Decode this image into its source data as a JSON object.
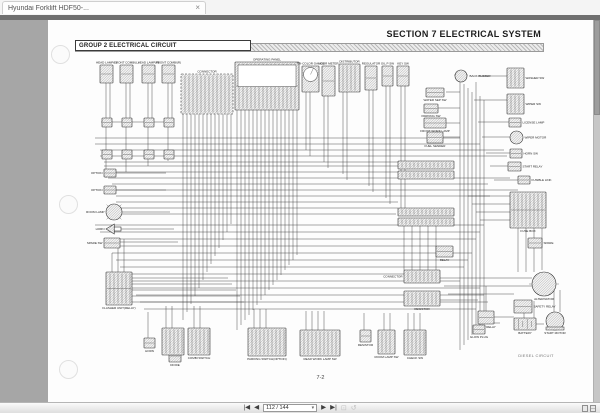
{
  "tab": {
    "title": "Hyundai Forklift HDF50-...",
    "close": "×"
  },
  "colors": {
    "appbar": "#6f6f6f",
    "viewer_bg": "#a6a6a6",
    "page_bg": "#fdfdfd"
  },
  "toolbar": {
    "first_icon": "|◀",
    "prev_icon": "◀",
    "page_value": "112 / 144",
    "dropdown_icon": "▾",
    "next_icon": "▶",
    "last_icon": "▶|",
    "snapshot_icon": "⊡",
    "refresh_icon": "↺"
  },
  "page": {
    "section_header": "SECTION 7  ELECTRICAL  SYSTEM",
    "group_label": "GROUP 2 ELECTRICAL CIRCUIT",
    "caption": "DIESEL CIRCUIT",
    "page_number": "7-2"
  },
  "diagram": {
    "components": [
      {
        "x": 52,
        "y": 45,
        "w": 13,
        "h": 18,
        "s": "conn",
        "l": "HEAD LAMP(L)",
        "p": "top"
      },
      {
        "x": 72,
        "y": 45,
        "w": 13,
        "h": 18,
        "s": "conn",
        "l": "FRONT COMBI(L)",
        "p": "top"
      },
      {
        "x": 94,
        "y": 45,
        "w": 13,
        "h": 18,
        "s": "conn",
        "l": "HEAD LAMP(R)",
        "p": "top"
      },
      {
        "x": 114,
        "y": 45,
        "w": 13,
        "h": 18,
        "s": "conn",
        "l": "FRONT COMBI(R)",
        "p": "top"
      },
      {
        "x": 54,
        "y": 98,
        "w": 10,
        "h": 9,
        "s": "conn"
      },
      {
        "x": 74,
        "y": 98,
        "w": 10,
        "h": 9,
        "s": "conn"
      },
      {
        "x": 96,
        "y": 98,
        "w": 10,
        "h": 9,
        "s": "conn"
      },
      {
        "x": 116,
        "y": 98,
        "w": 10,
        "h": 9,
        "s": "conn"
      },
      {
        "x": 54,
        "y": 130,
        "w": 10,
        "h": 9,
        "s": "conn"
      },
      {
        "x": 74,
        "y": 130,
        "w": 10,
        "h": 9,
        "s": "conn"
      },
      {
        "x": 96,
        "y": 130,
        "w": 10,
        "h": 9,
        "s": "conn"
      },
      {
        "x": 116,
        "y": 130,
        "w": 10,
        "h": 9,
        "s": "conn"
      },
      {
        "x": 133,
        "y": 54,
        "w": 52,
        "h": 40,
        "s": "dashedgrid",
        "l": "CONNECTOR",
        "p": "top"
      },
      {
        "x": 187,
        "y": 42,
        "w": 64,
        "h": 48,
        "s": "panel",
        "l": "OPERATING PANEL",
        "p": "top"
      },
      {
        "x": 254,
        "y": 46,
        "w": 17,
        "h": 26,
        "s": "gauge",
        "l": "TRI-COLOR GAUGE",
        "p": "top"
      },
      {
        "x": 274,
        "y": 46,
        "w": 13,
        "h": 30,
        "s": "conn",
        "l": "HOUR METER",
        "p": "top"
      },
      {
        "x": 291,
        "y": 44,
        "w": 21,
        "h": 28,
        "s": "grid",
        "l": "DISTRIBUTOR",
        "p": "top"
      },
      {
        "x": 317,
        "y": 46,
        "w": 12,
        "h": 24,
        "s": "conn",
        "l": "REGULATOR",
        "p": "top"
      },
      {
        "x": 334,
        "y": 46,
        "w": 11,
        "h": 20,
        "s": "conn",
        "l": "OIL P SW",
        "p": "top"
      },
      {
        "x": 349,
        "y": 46,
        "w": 12,
        "h": 20,
        "s": "conn",
        "l": "KEY SW",
        "p": "top"
      },
      {
        "x": 406,
        "y": 50,
        "w": 14,
        "h": 12,
        "s": "circle",
        "l": "BACK BUZZER",
        "p": "right"
      },
      {
        "x": 378,
        "y": 68,
        "w": 18,
        "h": 9,
        "s": "conn",
        "l": "WATER SEP SW",
        "p": "bottom"
      },
      {
        "x": 376,
        "y": 84,
        "w": 14,
        "h": 9,
        "s": "conn",
        "l": "PARKING SW",
        "p": "bottom"
      },
      {
        "x": 376,
        "y": 98,
        "w": 22,
        "h": 10,
        "s": "conn",
        "l": "FRONT WORK LAMP",
        "p": "bottom"
      },
      {
        "x": 379,
        "y": 112,
        "w": 16,
        "h": 11,
        "s": "conn",
        "l": "FUEL SENDER",
        "p": "bottom"
      },
      {
        "x": 459,
        "y": 48,
        "w": 17,
        "h": 20,
        "s": "grid",
        "l": "WASHER SW",
        "p": "right"
      },
      {
        "x": 459,
        "y": 74,
        "w": 17,
        "h": 20,
        "s": "grid",
        "l": "WIPER SW",
        "p": "right"
      },
      {
        "x": 461,
        "y": 98,
        "w": 12,
        "h": 9,
        "s": "conn",
        "l": "LICENSE LAMP",
        "p": "right"
      },
      {
        "x": 462,
        "y": 111,
        "w": 13,
        "h": 13,
        "s": "circle",
        "l": "WIPER MOTOR",
        "p": "right"
      },
      {
        "x": 462,
        "y": 129,
        "w": 12,
        "h": 9,
        "s": "conn",
        "l": "HORN SW",
        "p": "right"
      },
      {
        "x": 460,
        "y": 142,
        "w": 13,
        "h": 9,
        "s": "conn",
        "l": "START RELAY",
        "p": "right"
      },
      {
        "x": 470,
        "y": 156,
        "w": 12,
        "h": 8,
        "s": "conn",
        "l": "FUSIBLE LINK",
        "p": "right"
      },
      {
        "x": 462,
        "y": 172,
        "w": 36,
        "h": 36,
        "s": "fusebox",
        "l": "FUSE BOX",
        "p": "bottom"
      },
      {
        "x": 480,
        "y": 218,
        "w": 14,
        "h": 10,
        "s": "conn",
        "l": "SPARE",
        "p": "right"
      },
      {
        "x": 388,
        "y": 226,
        "w": 17,
        "h": 11,
        "s": "conn",
        "l": "RELAY",
        "p": "bottom"
      },
      {
        "x": 350,
        "y": 141,
        "w": 56,
        "h": 8,
        "s": "strip"
      },
      {
        "x": 350,
        "y": 151,
        "w": 56,
        "h": 8,
        "s": "strip"
      },
      {
        "x": 350,
        "y": 188,
        "w": 56,
        "h": 8,
        "s": "strip"
      },
      {
        "x": 350,
        "y": 198,
        "w": 56,
        "h": 8,
        "s": "strip"
      },
      {
        "x": 56,
        "y": 149,
        "w": 12,
        "h": 8,
        "s": "conn",
        "l": "OPTION",
        "p": "left"
      },
      {
        "x": 56,
        "y": 166,
        "w": 12,
        "h": 8,
        "s": "conn",
        "l": "OPTION",
        "p": "left"
      },
      {
        "x": 58,
        "y": 184,
        "w": 16,
        "h": 16,
        "s": "lamp",
        "l": "ROOM LAMP",
        "p": "left"
      },
      {
        "x": 58,
        "y": 204,
        "w": 15,
        "h": 10,
        "s": "horn",
        "l": "HORN",
        "p": "left"
      },
      {
        "x": 56,
        "y": 218,
        "w": 16,
        "h": 10,
        "s": "conn",
        "l": "SPARE SW",
        "p": "left"
      },
      {
        "x": 58,
        "y": 252,
        "w": 26,
        "h": 33,
        "s": "relay",
        "l": "FLASHER UNIT(RELAY)",
        "p": "bottom"
      },
      {
        "x": 121,
        "y": 330,
        "w": 12,
        "h": 12,
        "s": "conn",
        "l": "DIODE",
        "p": "bottom"
      },
      {
        "x": 96,
        "y": 318,
        "w": 11,
        "h": 10,
        "s": "conn",
        "l": "HORN",
        "p": "bottom"
      },
      {
        "x": 114,
        "y": 308,
        "w": 22,
        "h": 27,
        "s": "switchbox"
      },
      {
        "x": 140,
        "y": 308,
        "w": 22,
        "h": 27,
        "s": "switchbox",
        "l": "COMBI SWITCH",
        "p": "bottom"
      },
      {
        "x": 200,
        "y": 308,
        "w": 38,
        "h": 28,
        "s": "switchbox",
        "l": "PARKING SWITCH(OPTION)",
        "p": "bottom"
      },
      {
        "x": 252,
        "y": 310,
        "w": 40,
        "h": 26,
        "s": "switchbox",
        "l": "REAR WORK LAMP SW",
        "p": "bottom"
      },
      {
        "x": 312,
        "y": 310,
        "w": 11,
        "h": 12,
        "s": "conn",
        "l": "RESISTOR",
        "p": "bottom"
      },
      {
        "x": 330,
        "y": 310,
        "w": 17,
        "h": 24,
        "s": "switchbox",
        "l": "ROOM LAMP SW",
        "p": "bottom"
      },
      {
        "x": 356,
        "y": 310,
        "w": 22,
        "h": 25,
        "s": "switchbox",
        "l": "CHECK SW",
        "p": "bottom"
      },
      {
        "x": 356,
        "y": 250,
        "w": 36,
        "h": 13,
        "s": "strip",
        "l": "CONNECTOR",
        "p": "left"
      },
      {
        "x": 356,
        "y": 271,
        "w": 36,
        "h": 15,
        "s": "grid",
        "l": "RESISTOR",
        "p": "bottom"
      },
      {
        "x": 484,
        "y": 252,
        "w": 24,
        "h": 24,
        "s": "alt",
        "l": "ALTERNATOR",
        "p": "bottom"
      },
      {
        "x": 466,
        "y": 280,
        "w": 18,
        "h": 13,
        "s": "conn",
        "l": "SAFETY RELAY",
        "p": "right"
      },
      {
        "x": 430,
        "y": 291,
        "w": 16,
        "h": 13,
        "s": "conn",
        "l": "GLOW RELAY",
        "p": "bottom"
      },
      {
        "x": 425,
        "y": 305,
        "w": 12,
        "h": 9,
        "s": "conn",
        "l": "GLOW PLUG",
        "p": "bottom"
      },
      {
        "x": 466,
        "y": 298,
        "w": 22,
        "h": 12,
        "s": "battery",
        "l": "BATTERY",
        "p": "bottom"
      },
      {
        "x": 496,
        "y": 292,
        "w": 22,
        "h": 18,
        "s": "motor",
        "l": "START MOTOR",
        "p": "bottom"
      }
    ],
    "wires": {
      "v": [
        [
          58,
          63,
          98
        ],
        [
          62,
          63,
          98
        ],
        [
          78,
          63,
          98
        ],
        [
          82,
          63,
          98
        ],
        [
          100,
          63,
          98
        ],
        [
          104,
          63,
          98
        ],
        [
          120,
          63,
          98
        ],
        [
          124,
          63,
          98
        ],
        [
          58,
          107,
          130
        ],
        [
          78,
          107,
          130
        ],
        [
          100,
          107,
          130
        ],
        [
          120,
          107,
          130
        ],
        [
          58,
          139,
          158
        ],
        [
          78,
          139,
          152
        ],
        [
          100,
          139,
          146
        ],
        [
          120,
          139,
          141
        ],
        [
          135,
          94,
          300
        ],
        [
          139,
          94,
          292
        ],
        [
          143,
          94,
          284
        ],
        [
          147,
          94,
          276
        ],
        [
          151,
          94,
          268
        ],
        [
          155,
          94,
          260
        ],
        [
          159,
          94,
          252
        ],
        [
          163,
          94,
          244
        ],
        [
          167,
          94,
          236
        ],
        [
          171,
          94,
          228
        ],
        [
          175,
          94,
          220
        ],
        [
          179,
          94,
          212
        ],
        [
          183,
          94,
          204
        ],
        [
          189,
          90,
          310
        ],
        [
          193,
          90,
          305
        ],
        [
          197,
          90,
          300
        ],
        [
          201,
          90,
          295
        ],
        [
          205,
          90,
          290
        ],
        [
          209,
          90,
          285
        ],
        [
          213,
          90,
          280
        ],
        [
          217,
          90,
          275
        ],
        [
          221,
          90,
          270
        ],
        [
          225,
          90,
          265
        ],
        [
          229,
          90,
          260
        ],
        [
          233,
          90,
          255
        ],
        [
          237,
          90,
          250
        ],
        [
          241,
          90,
          245
        ],
        [
          245,
          90,
          240
        ],
        [
          249,
          90,
          235
        ],
        [
          258,
          72,
          130
        ],
        [
          262,
          72,
          136
        ],
        [
          276,
          76,
          142
        ],
        [
          280,
          76,
          148
        ],
        [
          295,
          72,
          154
        ],
        [
          299,
          72,
          160
        ],
        [
          321,
          70,
          166
        ],
        [
          325,
          70,
          172
        ],
        [
          338,
          66,
          178
        ],
        [
          342,
          66,
          184
        ],
        [
          353,
          66,
          190
        ],
        [
          357,
          66,
          196
        ],
        [
          412,
          60,
          330
        ],
        [
          416,
          64,
          325
        ],
        [
          420,
          68,
          320
        ],
        [
          424,
          72,
          315
        ],
        [
          428,
          62,
          310
        ],
        [
          432,
          76,
          305
        ],
        [
          436,
          80,
          300
        ],
        [
          356,
          206,
          250
        ],
        [
          364,
          206,
          250
        ],
        [
          372,
          206,
          250
        ],
        [
          380,
          206,
          250
        ],
        [
          388,
          206,
          250
        ],
        [
          470,
          208,
          252
        ],
        [
          478,
          208,
          252
        ],
        [
          486,
          208,
          252
        ],
        [
          494,
          208,
          250
        ],
        [
          100,
          292,
          318
        ],
        [
          118,
          286,
          308
        ],
        [
          124,
          286,
          308
        ],
        [
          146,
          286,
          308
        ],
        [
          152,
          286,
          308
        ],
        [
          206,
          289,
          308
        ],
        [
          212,
          289,
          308
        ],
        [
          218,
          289,
          308
        ],
        [
          258,
          291,
          310
        ],
        [
          264,
          291,
          310
        ],
        [
          270,
          291,
          310
        ],
        [
          276,
          291,
          310
        ],
        [
          316,
          293,
          310
        ],
        [
          336,
          293,
          310
        ],
        [
          342,
          293,
          310
        ],
        [
          360,
          293,
          310
        ],
        [
          366,
          293,
          310
        ],
        [
          372,
          293,
          310
        ],
        [
          438,
          266,
          291
        ],
        [
          476,
          286,
          298
        ],
        [
          486,
          281,
          298
        ],
        [
          506,
          264,
          292
        ],
        [
          512,
          270,
          292
        ],
        [
          64,
          233,
          252
        ],
        [
          70,
          226,
          252
        ],
        [
          76,
          219,
          252
        ]
      ],
      "h": [
        [
          53,
          102,
          126
        ],
        [
          47,
          118,
          412
        ],
        [
          47,
          124,
          432
        ],
        [
          52,
          130,
          456
        ],
        [
          52,
          136,
          459
        ],
        [
          56,
          142,
          350
        ],
        [
          56,
          146,
          350
        ],
        [
          60,
          152,
          350
        ],
        [
          60,
          158,
          462
        ],
        [
          64,
          164,
          440
        ],
        [
          64,
          170,
          470
        ],
        [
          68,
          176,
          442
        ],
        [
          68,
          182,
          350
        ],
        [
          72,
          188,
          350
        ],
        [
          74,
          194,
          348
        ],
        [
          47,
          205,
          436
        ],
        [
          52,
          212,
          432
        ],
        [
          56,
          219,
          428
        ],
        [
          60,
          226,
          388
        ],
        [
          64,
          233,
          424
        ],
        [
          68,
          240,
          420
        ],
        [
          72,
          247,
          416
        ],
        [
          76,
          254,
          356
        ],
        [
          80,
          261,
          412
        ],
        [
          84,
          268,
          432
        ],
        [
          88,
          275,
          436
        ],
        [
          92,
          282,
          440
        ],
        [
          96,
          289,
          428
        ],
        [
          68,
          153,
          118
        ],
        [
          68,
          170,
          118
        ],
        [
          74,
          192,
          122
        ],
        [
          73,
          209,
          126
        ],
        [
          72,
          222,
          130
        ],
        [
          84,
          258,
          180
        ],
        [
          84,
          264,
          184
        ],
        [
          84,
          270,
          188
        ],
        [
          84,
          276,
          192
        ],
        [
          84,
          282,
          196
        ],
        [
          430,
          56,
          459
        ],
        [
          426,
          80,
          459
        ],
        [
          430,
          102,
          461
        ],
        [
          434,
          117,
          462
        ],
        [
          438,
          133,
          462
        ],
        [
          442,
          146,
          460
        ],
        [
          446,
          160,
          470
        ],
        [
          398,
          72,
          412
        ],
        [
          390,
          88,
          412
        ],
        [
          398,
          103,
          412
        ],
        [
          395,
          117,
          412
        ],
        [
          420,
          55,
          406
        ],
        [
          420,
          176,
          462
        ],
        [
          424,
          184,
          462
        ],
        [
          428,
          192,
          462
        ],
        [
          432,
          200,
          462
        ],
        [
          392,
          258,
          484
        ],
        [
          396,
          266,
          484
        ],
        [
          400,
          274,
          466
        ],
        [
          446,
          297,
          466
        ],
        [
          488,
          304,
          496
        ],
        [
          392,
          280,
          430
        ],
        [
          437,
          303,
          452
        ]
      ]
    }
  }
}
